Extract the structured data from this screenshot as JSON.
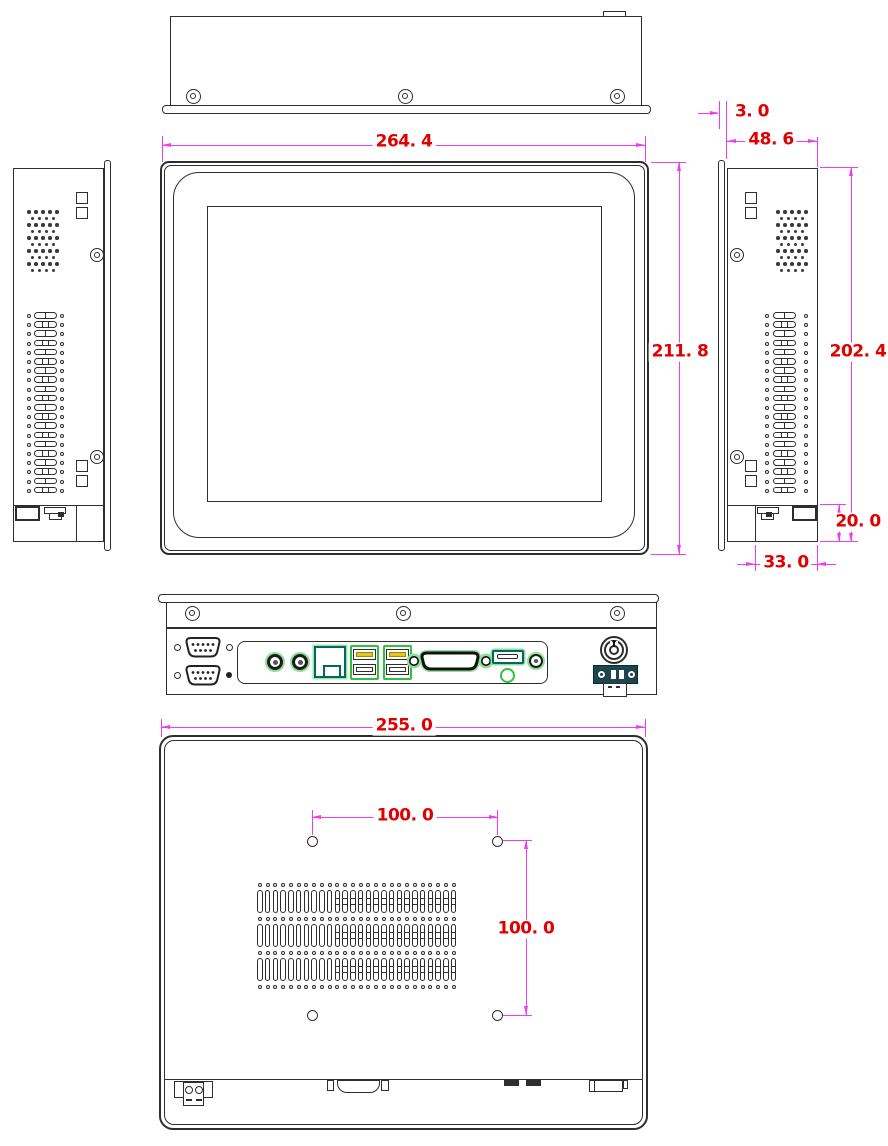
{
  "drawing": {
    "dimension_labels": {
      "top_width": "264. 4",
      "front_height": "211. 8",
      "bezel_offset": "3. 0",
      "depth": "48. 6",
      "side_height": "202. 4",
      "bottom_step_height": "20. 0",
      "bottom_step_depth": "33. 0",
      "rear_width": "255. 0",
      "vesa_width": "100. 0",
      "vesa_height": "100. 0"
    },
    "colors": {
      "drawing_line": "#2e2e2e",
      "dimension_line": "#ee3cee",
      "dimension_text": "#e00000",
      "port_highlight_green": "#2fc13f",
      "port_glow_green": "#8fdf97",
      "port_teal": "#00695f",
      "usb_tongue_yellow": "#e5c41c",
      "terminal_block_teal": "#1a474f"
    }
  }
}
